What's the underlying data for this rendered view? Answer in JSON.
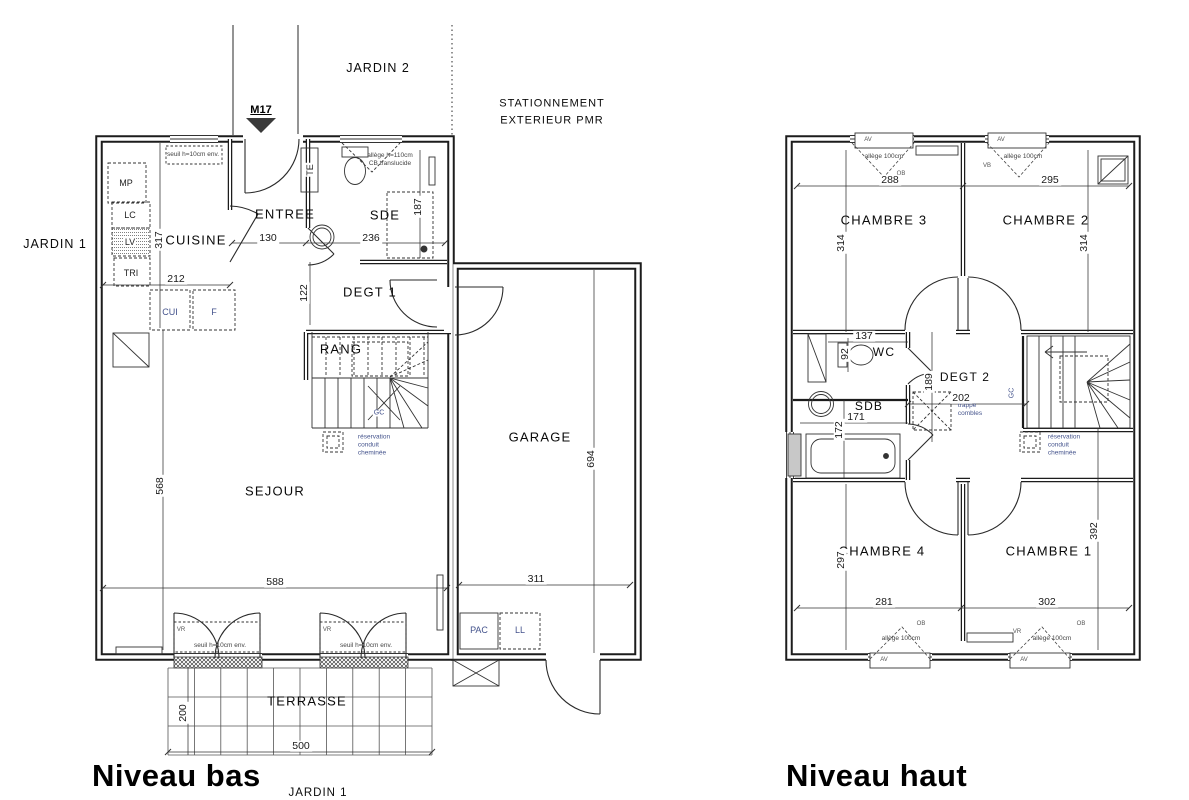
{
  "colors": {
    "line": "#1c1c1c",
    "accent": "#44538c",
    "note": "#444444"
  },
  "low": {
    "title": "Niveau bas",
    "site": {
      "jardin2": "JARDIN 2",
      "jardin1_left": "JARDIN 1",
      "jardin1_bottom": "JARDIN 1",
      "stationnement": "STATIONNEMENT\nEXTERIEUR PMR",
      "marker": "M17"
    },
    "rooms": {
      "cuisine": "CUISINE",
      "entree": "ENTREE",
      "sde": "SDE",
      "degt1": "DEGT 1",
      "rang": "RANG",
      "sejour": "SEJOUR",
      "garage": "GARAGE",
      "terrasse": "TERRASSE"
    },
    "fixtures": {
      "mp": "MP",
      "lc": "LC",
      "lv": "LV",
      "tri": "TRI",
      "cui": "CUI",
      "f": "F",
      "te": "TE",
      "gc": "GC",
      "pac": "PAC",
      "ll": "LL"
    },
    "dims": {
      "kitchen_h": "317",
      "kitchen_w": "212",
      "entree_w": "130",
      "sde_w": "236",
      "sde_h": "187",
      "degt_h": "122",
      "sejour_h": "568",
      "sejour_w": "588",
      "garage_h": "694",
      "garage_w": "311",
      "terrasse_h": "200",
      "terrasse_w": "500"
    },
    "notes": {
      "seuil": "seuil h=10cm env.",
      "allege": "allège h=110cm\nCB translucide",
      "reservation": "réservation\nconduit\ncheminée",
      "vr": "VR"
    }
  },
  "high": {
    "title": "Niveau haut",
    "rooms": {
      "ch3": "CHAMBRE 3",
      "ch2": "CHAMBRE 2",
      "ch4": "CHAMBRE 4",
      "ch1": "CHAMBRE 1",
      "wc": "WC",
      "sdb": "SDB",
      "degt2": "DEGT 2"
    },
    "dims": {
      "ch3_w": "288",
      "ch2_w": "295",
      "ch3_h": "314",
      "ch2_h": "314",
      "wc_w": "137",
      "wc_h": "92",
      "sdb_w": "171",
      "sdb_h": "172",
      "degt2_h": "189",
      "degt2_w": "202",
      "ch4_h": "297",
      "ch1_h": "392",
      "ch4_w": "281",
      "ch1_w": "302"
    },
    "notes": {
      "av": "AV",
      "vb": "VB",
      "ob": "OB",
      "vr": "VR",
      "allege": "allège 100cm",
      "trappe": "trappe\ncombles",
      "reservation": "réservation\nconduit\ncheminée",
      "gc": "GC"
    }
  }
}
